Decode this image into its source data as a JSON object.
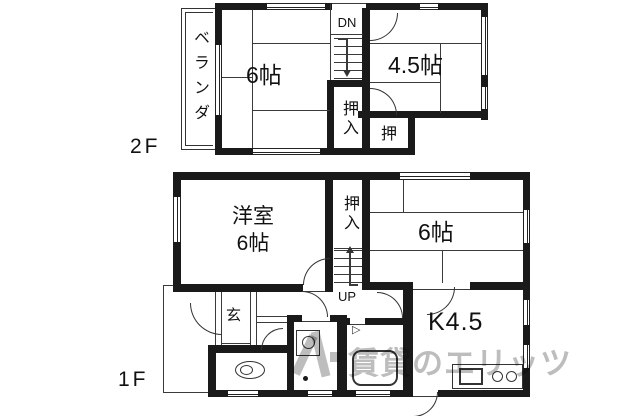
{
  "floors": {
    "f2": {
      "label": "2F",
      "veranda": "ベランダ",
      "room6": "6帖",
      "stairs": "DN",
      "oshiire": "押入",
      "room45": "4.5帖",
      "oshi": "押"
    },
    "f1": {
      "label": "1F",
      "western_room_line1": "洋室",
      "western_room_line2": "6帖",
      "oshiire": "押入",
      "room6": "6帖",
      "stairs": "UP",
      "genkan": "玄",
      "kitchen": "K4.5",
      "bath_marker": "▷"
    }
  },
  "watermark": {
    "text": "賃貸のエリッツ"
  },
  "colors": {
    "wall": "#1a1a1a",
    "line": "#3a3a3a",
    "text": "#111111",
    "watermark": "#bdbdbd"
  }
}
